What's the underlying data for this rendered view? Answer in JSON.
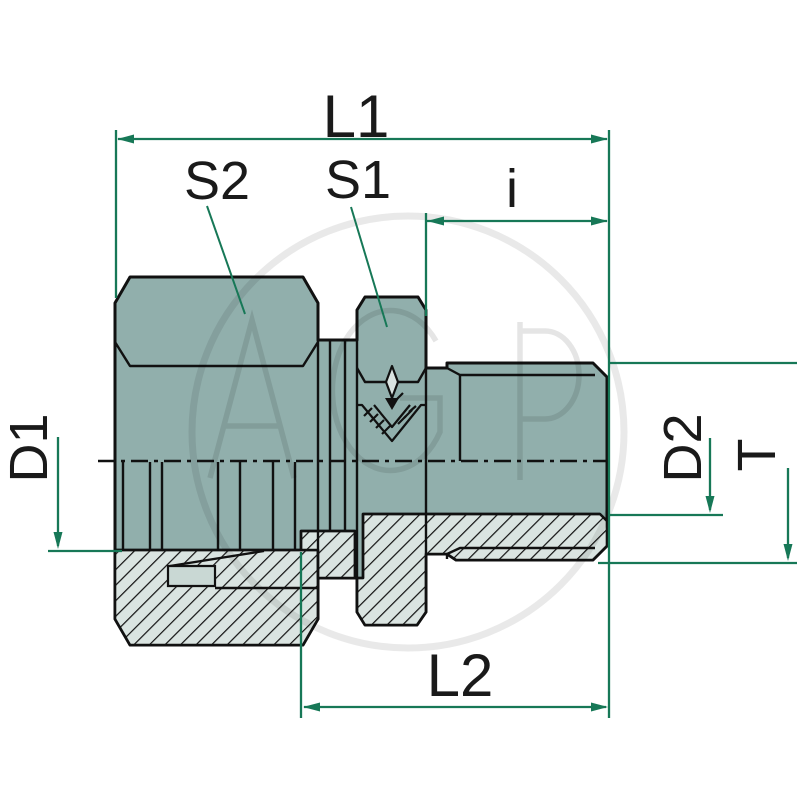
{
  "labels": {
    "L1": "L1",
    "S2": "S2",
    "S1": "S1",
    "i": "i",
    "D1": "D1",
    "D2": "D2",
    "T": "T",
    "L2": "L2"
  },
  "watermark": {
    "text": "AGP"
  },
  "colors": {
    "dimension_green": "#177857",
    "body_teal": "#91AFAC",
    "section_light": "#DAE4E1",
    "ring_highlight": "#C9D8D4",
    "outline_black": "#111111",
    "label_black": "#1A1A1A"
  }
}
